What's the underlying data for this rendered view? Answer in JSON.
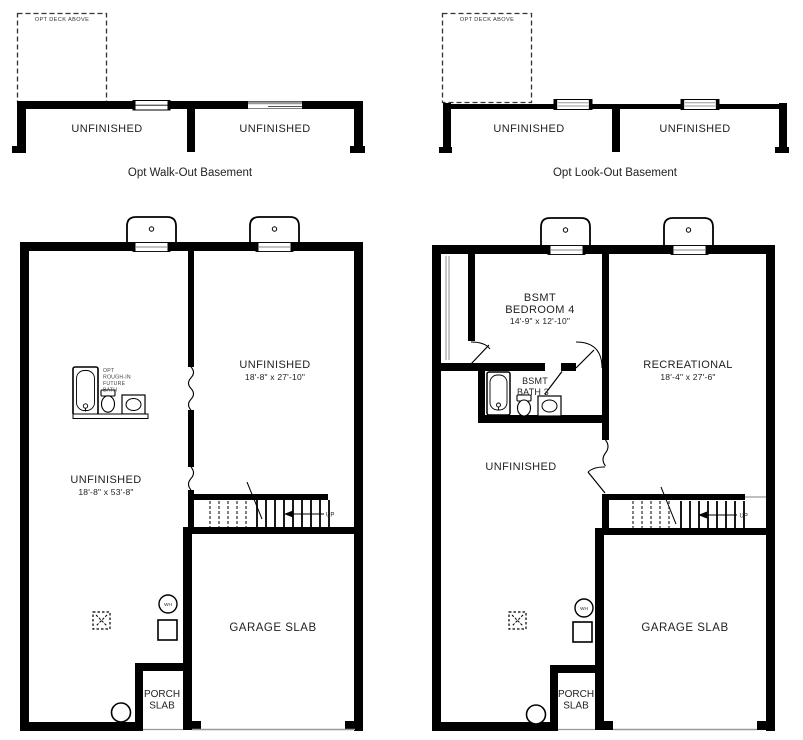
{
  "walkout": {
    "deck": "OPT DECK ABOVE",
    "left_room": "UNFINISHED",
    "right_room": "UNFINISHED",
    "caption": "Opt Walk-Out Basement"
  },
  "lookout": {
    "deck": "OPT DECK ABOVE",
    "left_room": "UNFINISHED",
    "right_room": "UNFINISHED",
    "caption": "Opt Look-Out Basement"
  },
  "plan_a": {
    "unfinished_right": {
      "name": "UNFINISHED",
      "dims": "18'-8\" x 27'-10\""
    },
    "unfinished_left": {
      "name": "UNFINISHED",
      "dims": "18'-8\" x 53'-8\""
    },
    "rough_in": [
      "OPT",
      "ROUGH-IN",
      "FUTURE",
      "BATH"
    ],
    "garage": "GARAGE SLAB",
    "porch": [
      "PORCH",
      "SLAB"
    ],
    "stairs_up": "UP",
    "water_heater": "WH"
  },
  "plan_b": {
    "bedroom": [
      "BSMT",
      "BEDROOM 4",
      "14'-9\" x 12'-10\""
    ],
    "bath": [
      "BSMT",
      "BATH 3"
    ],
    "recreational": {
      "name": "RECREATIONAL",
      "dims": "18'-4\" x 27'-6\""
    },
    "unfinished": "UNFINISHED",
    "garage": "GARAGE SLAB",
    "porch": [
      "PORCH",
      "SLAB"
    ],
    "stairs_up": "UP",
    "water_heater": "WH"
  },
  "colors": {
    "wall": "#000000",
    "accent_gray": "#999999",
    "text": "#222222"
  }
}
